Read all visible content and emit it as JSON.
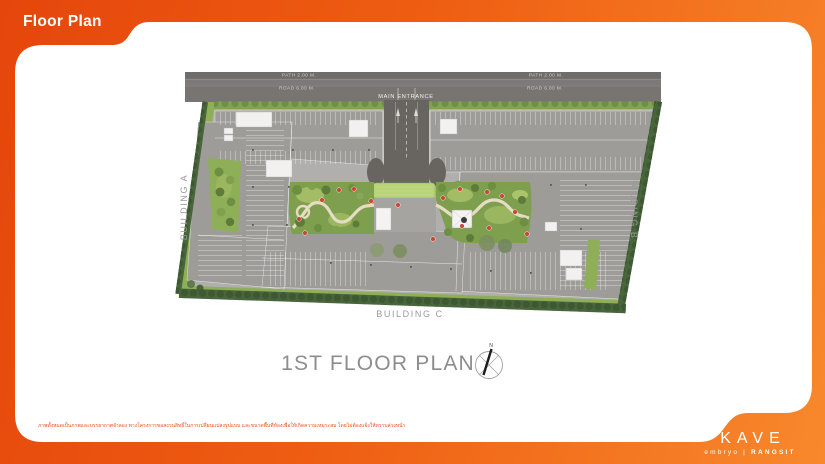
{
  "header": {
    "title": "Floor Plan"
  },
  "plan": {
    "road": {
      "path_label": "PATH 2.00 M.",
      "road_label": "ROAD 6.00 M.",
      "main_entrance": "MAIN ENTRANCE"
    },
    "buildings": {
      "a": "BUILDING A",
      "b": "BUILDING B",
      "c": "BUILDING C"
    },
    "caption": "1ST FLOOR PLAN",
    "compass_north": "N"
  },
  "footer": {
    "disclaimer": "ภาพทั้งหมดเป็นภาพและบรรยากาศจำลอง ทางโครงการขอสงวนสิทธิ์ในการเปลี่ยนแปลงรูปแบบ และขนาดพื้นที่ห้องเพื่อให้เกิดความเหมาะสม โดยไม่ต้องแจ้งให้ทราบล่วงหน้า",
    "brand": {
      "name": "KAVE",
      "sub_left": "embryo",
      "divider": "|",
      "sub_right": "RANGSIT"
    }
  },
  "colors": {
    "accent_orange": "#ee5a10",
    "card_white": "#ffffff",
    "site_green": "#8fae58",
    "hedge_green": "#48653b",
    "building_gray": "#9e9c99",
    "road_gray": "#7c7978",
    "label_gray": "#9b9b9b",
    "marker_red": "#cc4636"
  }
}
